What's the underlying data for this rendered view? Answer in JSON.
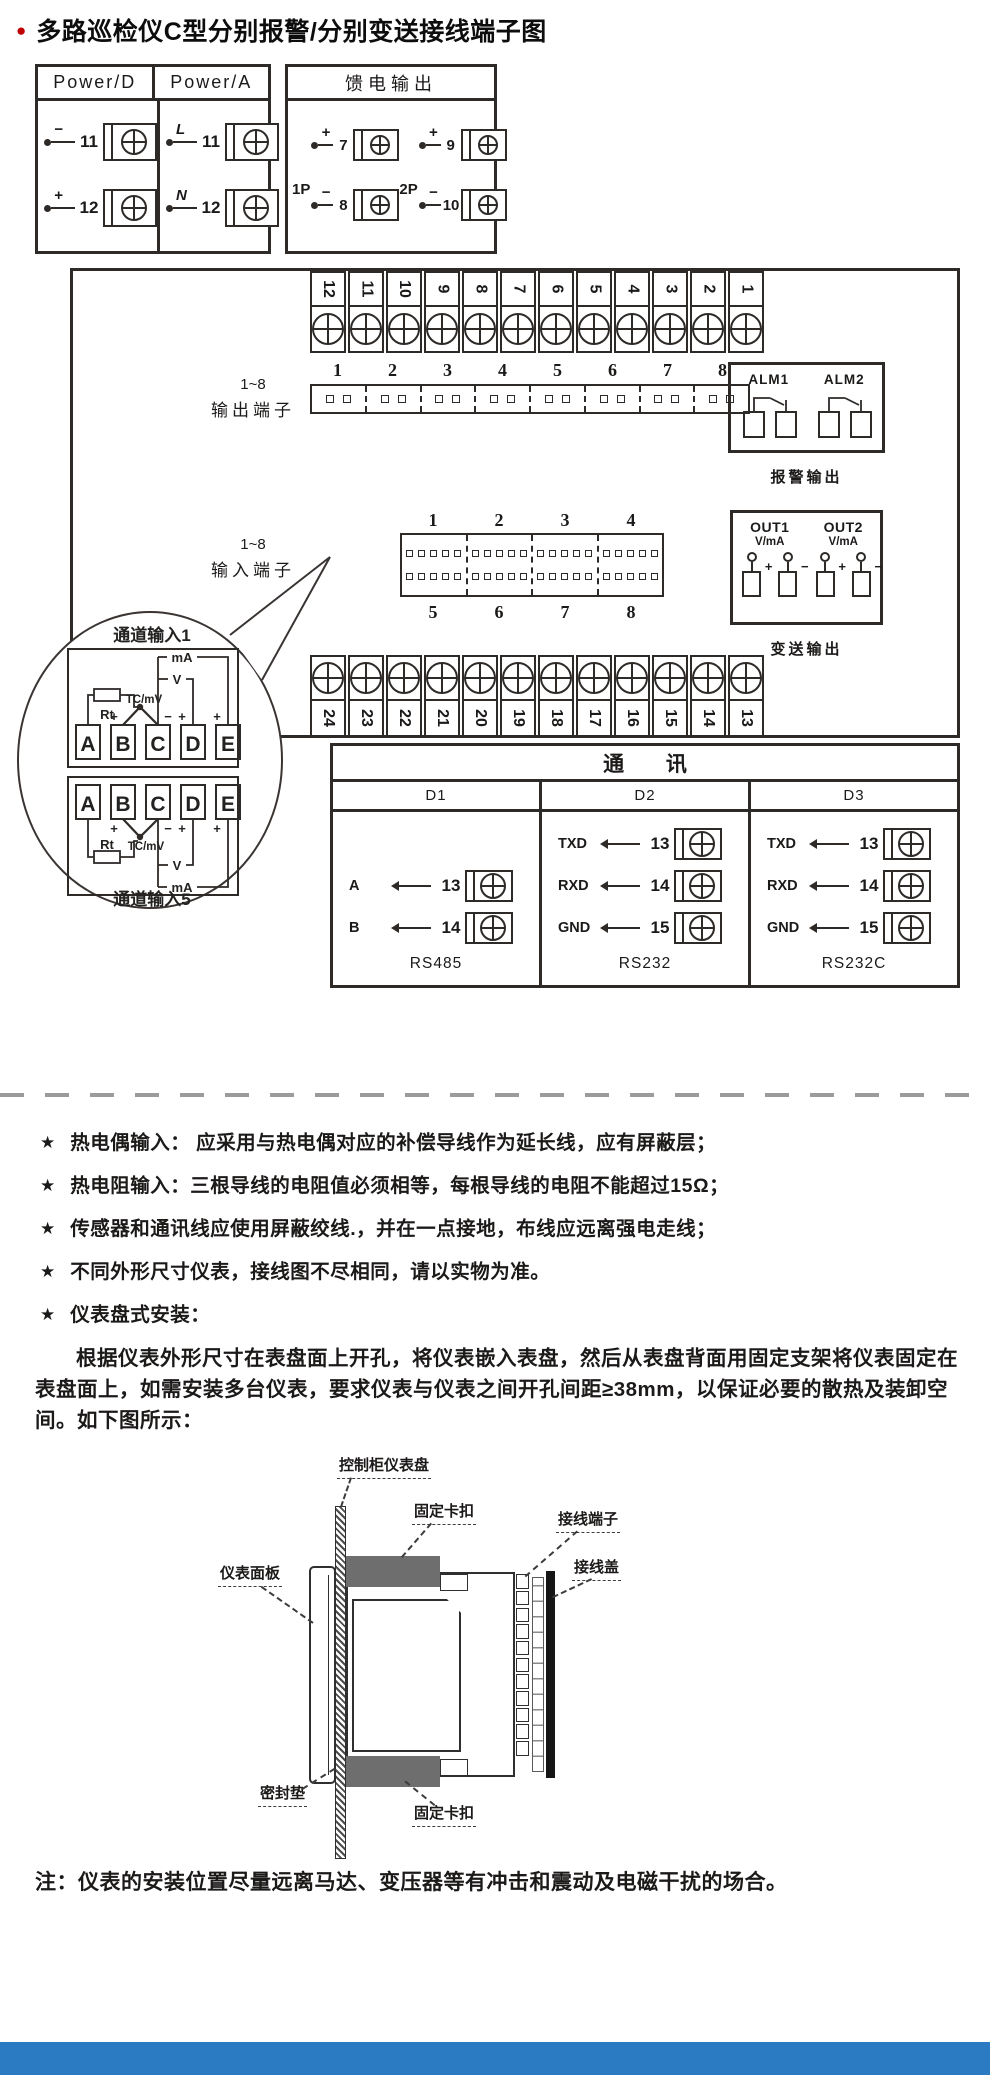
{
  "glyphs": {
    "bullet": "●",
    "star": "★",
    "plus": "+",
    "minus": "−"
  },
  "title": "多路巡检仪C型分别报警/分别变送接线端子图",
  "power_d": {
    "label": "Power/D",
    "terminals": [
      {
        "sign": "−",
        "num": "11"
      },
      {
        "sign": "+",
        "num": "12"
      }
    ]
  },
  "power_a": {
    "label": "Power/A",
    "terminals": [
      {
        "sign": "L",
        "num": "11"
      },
      {
        "sign": "N",
        "num": "12"
      }
    ]
  },
  "feed_output": {
    "label": "馈电输出",
    "groups": [
      {
        "name": "1P",
        "terminals": [
          {
            "sign": "+",
            "num": "7"
          },
          {
            "sign": "−",
            "num": "8"
          }
        ]
      },
      {
        "name": "2P",
        "terminals": [
          {
            "sign": "+",
            "num": "9"
          },
          {
            "sign": "−",
            "num": "10"
          }
        ]
      }
    ]
  },
  "top_strip": [
    "12",
    "11",
    "10",
    "9",
    "8",
    "7",
    "6",
    "5",
    "4",
    "3",
    "2",
    "1"
  ],
  "bottom_strip": [
    "24",
    "23",
    "22",
    "21",
    "20",
    "19",
    "18",
    "17",
    "16",
    "15",
    "14",
    "13"
  ],
  "output_block": {
    "range": "1~8",
    "label": "输出端子",
    "numbers": [
      "1",
      "2",
      "3",
      "4",
      "5",
      "6",
      "7",
      "8"
    ]
  },
  "alarm_block": {
    "labels": [
      "ALM1",
      "ALM2"
    ],
    "caption": "报警输出"
  },
  "input_block": {
    "range": "1~8",
    "label": "输入端子",
    "top_numbers": [
      "1",
      "2",
      "3",
      "4"
    ],
    "bottom_numbers": [
      "5",
      "6",
      "7",
      "8"
    ]
  },
  "out_block": {
    "caption": "变送输出",
    "outputs": [
      {
        "name": "OUT1",
        "unit": "V/mA"
      },
      {
        "name": "OUT2",
        "unit": "V/mA"
      }
    ]
  },
  "channel_bubble": {
    "top_label": "通道输入1",
    "bottom_label": "通道输入5",
    "terminals": [
      "A",
      "B",
      "C",
      "D",
      "E"
    ],
    "rt": "Rt",
    "tc": "TC/mV",
    "v": "V",
    "ma": "mA",
    "sign_b": "+",
    "sign_c": "−",
    "sign_d": "+",
    "sign_e": "+"
  },
  "comm_table": {
    "title": "通 讯",
    "columns": [
      {
        "header": "D1",
        "caption": "RS485",
        "rows": [
          {
            "signal": "A",
            "num": "13"
          },
          {
            "signal": "B",
            "num": "14"
          }
        ]
      },
      {
        "header": "D2",
        "caption": "RS232",
        "rows": [
          {
            "signal": "TXD",
            "num": "13"
          },
          {
            "signal": "RXD",
            "num": "14"
          },
          {
            "signal": "GND",
            "num": "15"
          }
        ]
      },
      {
        "header": "D3",
        "caption": "RS232C",
        "rows": [
          {
            "signal": "TXD",
            "num": "13"
          },
          {
            "signal": "RXD",
            "num": "14"
          },
          {
            "signal": "GND",
            "num": "15"
          }
        ]
      }
    ]
  },
  "notes": [
    "热电偶输入： 应采用与热电偶对应的补偿导线作为延长线，应有屏蔽层；",
    "热电阻输入：三根导线的电阻值必须相等，每根导线的电阻不能超过15Ω；",
    "传感器和通讯线应使用屏蔽绞线.，并在一点接地，布线应远离强电走线；",
    "不同外形尺寸仪表，接线图不尽相同，请以实物为准。",
    "仪表盘式安装："
  ],
  "install": {
    "paragraph": "根据仪表外形尺寸在表盘面上开孔，将仪表嵌入表盘，然后从表盘背面用固定支架将仪表固定在表盘面上，如需安装多台仪表，要求仪表与仪表之间开孔间距≥38mm，以保证必要的散热及装卸空间。如下图所示：",
    "labels": {
      "panel": "控制柜仪表盘",
      "clip_top": "固定卡扣",
      "terminal": "接线端子",
      "cover": "接线盖",
      "front": "仪表面板",
      "seal": "密封垫",
      "clip_bottom": "固定卡扣"
    }
  },
  "bottom_note": "注：仪表的安装位置尽量远离马达、变压器等有冲击和震动及电磁干扰的场合。",
  "colors": {
    "accent_red": "#c00000",
    "footer_blue": "#2b7bc3",
    "line": "#2e2a28",
    "clip_gray": "#6e6e6e"
  }
}
